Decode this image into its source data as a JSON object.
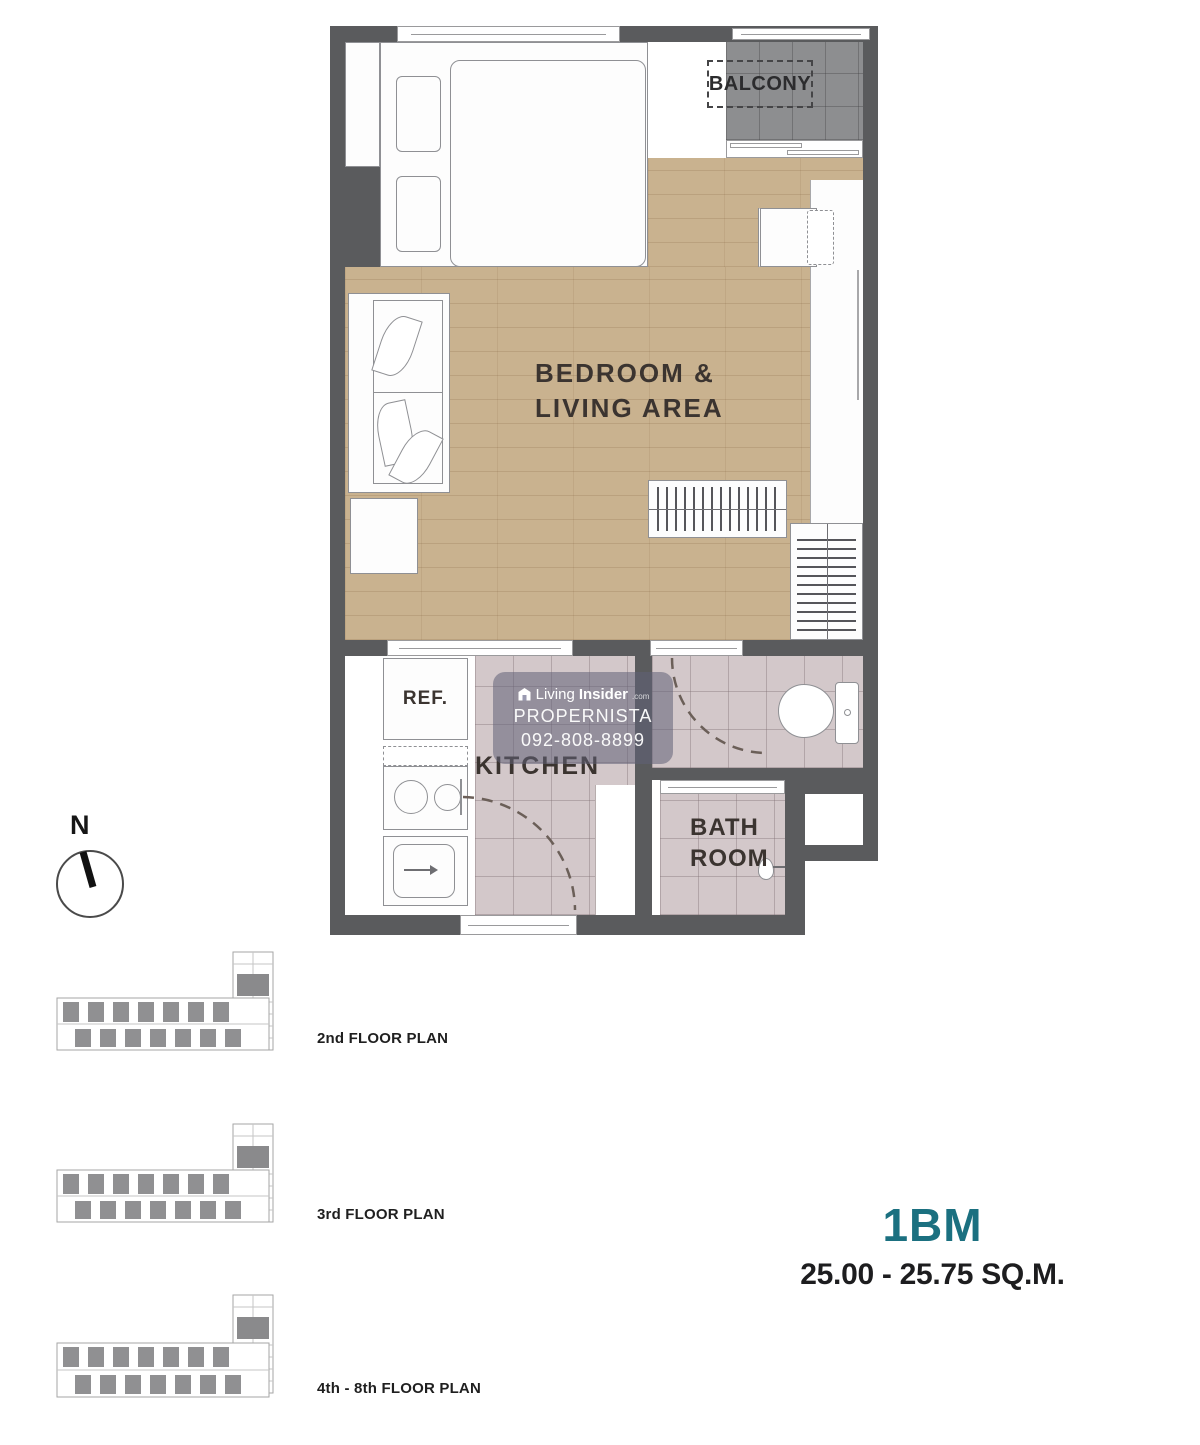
{
  "colors": {
    "accent_teal": "#1b7080",
    "wall_gray": "#5a5b5d",
    "wood_floor": "#c9b28f",
    "tile_floor": "#d3c8ca",
    "balcony_tile": "#8d8e90"
  },
  "plan": {
    "balcony_label": "BALCONY",
    "bedroom_living_line1": "BEDROOM &",
    "bedroom_living_line2": "LIVING AREA",
    "ref_label": "REF.",
    "kitchen_label": "KITCHEN",
    "bath_line1": "BATH",
    "bath_line2": "ROOM"
  },
  "watermark": {
    "brand_prefix": "Living",
    "brand_suffix": "Insider",
    "brand_tld": ".com",
    "line2": "PROPERNISTA",
    "line3": "092-808-8899"
  },
  "compass": {
    "north_label": "N"
  },
  "floor_thumbnails": [
    {
      "label": "2nd FLOOR PLAN"
    },
    {
      "label": "3rd FLOOR PLAN"
    },
    {
      "label": "4th - 8th FLOOR PLAN"
    }
  ],
  "unit": {
    "code": "1BM",
    "area_range": "25.00 - 25.75 SQ.M."
  }
}
